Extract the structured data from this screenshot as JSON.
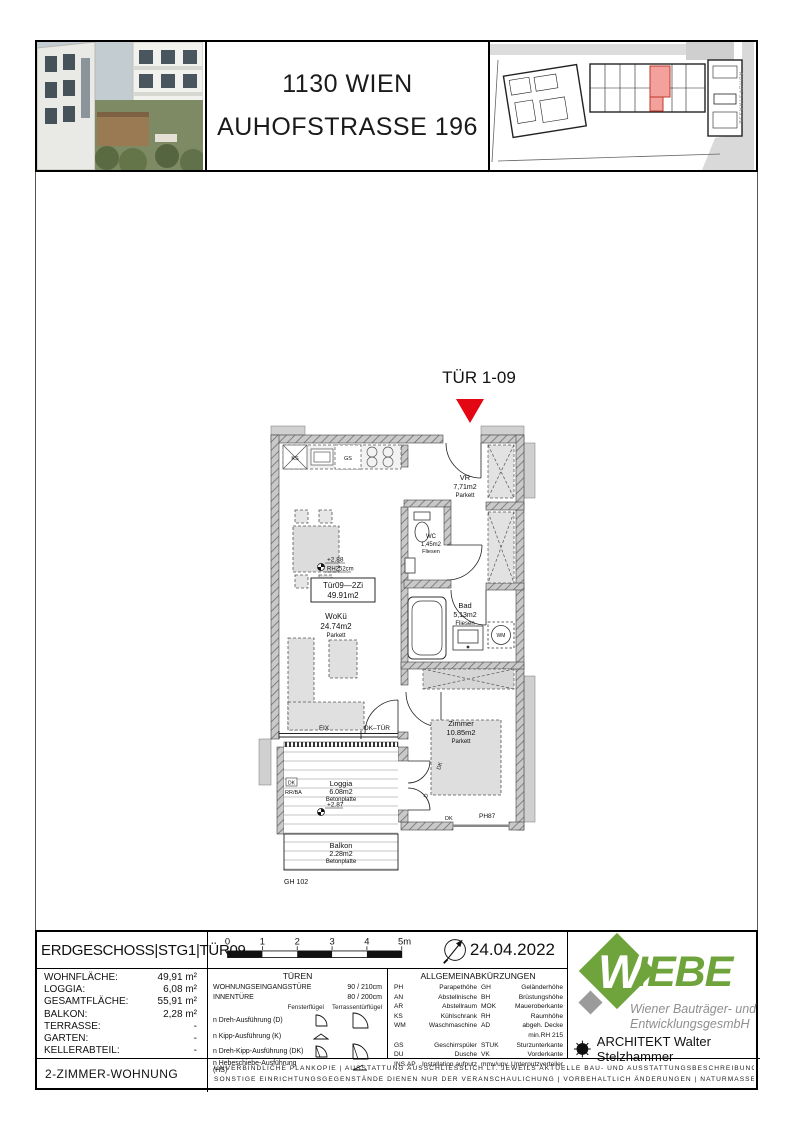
{
  "colors": {
    "accent_red": "#e30613",
    "logo_green": "#6fa43c",
    "siteplan_highlight": "#f2a19c",
    "siteplan_highlight_border": "#c0392b"
  },
  "header": {
    "city_line": "1130 WIEN",
    "street_line": "AUHOFSTRASSE 196",
    "siteplan_street": "AUHOFSTRASSE"
  },
  "plan": {
    "entrance_label": "TÜR 1-09",
    "rooms": {
      "vr": {
        "name": "VR",
        "area": "7,71m2",
        "floor": "Parkett"
      },
      "wc": {
        "name": "WC",
        "area": "1,45m2",
        "floor": "Fliesen"
      },
      "bad": {
        "name": "Bad",
        "area": "5,13m2",
        "floor": "Fliesen"
      },
      "woku": {
        "name": "WoKü",
        "area": "24.74m2",
        "floor": "Parkett"
      },
      "zimmer": {
        "name": "Zimmer",
        "area": "10.85m2",
        "floor": "Parkett"
      },
      "loggia": {
        "name": "Loggia",
        "area": "6.08m2",
        "floor": "Betonplatte"
      },
      "balkon": {
        "name": "Balkon",
        "area": "2.28m2",
        "floor": "Betonplatte"
      }
    },
    "unit_box": {
      "line1": "Tür09—2Zi",
      "line2": "49.91m2"
    },
    "levels": {
      "main": "+2.88",
      "main_rh": "RH252cm",
      "loggia": "+2.87"
    },
    "annotations": {
      "fix": "FIX",
      "dk_tuer": "DK–TÜR",
      "gh": "GH 102",
      "ph": "PH87",
      "ks": "KS",
      "gs": "GS",
      "wm": "WM",
      "rr_ba": "RR/BA",
      "dk": "DK",
      "d": "D"
    }
  },
  "title_block": {
    "plan_title": "ERDGESCHOSS|STG1|TÜR09",
    "areas": [
      {
        "label": "WOHNFLÄCHE:",
        "value": "49,91 m²"
      },
      {
        "label": "LOGGIA:",
        "value": "6,08 m²"
      },
      {
        "label": "GESAMTFLÄCHE:",
        "value": "55,91 m²"
      },
      {
        "label": "BALKON:",
        "value": "2,28 m²"
      },
      {
        "label": "TERRASSE:",
        "value": "-"
      },
      {
        "label": "GARTEN:",
        "value": "-"
      },
      {
        "label": "KELLERABTEIL:",
        "value": "-"
      }
    ],
    "unit_type": "2-ZIMMER-WOHNUNG",
    "scale_ticks": [
      "0",
      "1",
      "2",
      "3",
      "4",
      "5m"
    ],
    "date": "24.04.2022",
    "doors": {
      "title": "TÜREN",
      "entrance_label": "WOHNUNGSEINGANGSTÜRE",
      "entrance_size": "90 / 210cm",
      "inner_label": "INNENTÜRE",
      "inner_size": "80 / 200cm",
      "col_window": "Fensterflügel",
      "col_terrace": "Terrassentürflügel",
      "types": [
        "n Dreh-Ausführung (D)",
        "n Kipp-Ausführung (K)",
        "n Dreh-Kipp-Ausführung (DK)",
        "n Hebeschiebe-Ausführung (HS)"
      ]
    },
    "abbreviations": {
      "title": "ALLGEMEINABKÜRZUNGEN",
      "rows": [
        [
          "PH",
          "Parapethöhe",
          "GH",
          "Geländerhöhe"
        ],
        [
          "AN",
          "Abstellnische",
          "BH",
          "Brüstungshöhe"
        ],
        [
          "AR",
          "Abstellraum",
          "MOK",
          "Maueroberkante"
        ],
        [
          "KS",
          "Kühlschrank",
          "RH",
          "Raumhöhe"
        ],
        [
          "WM",
          "Waschmaschine",
          "AD",
          "abgeh. Decke min.RH 215"
        ],
        [
          "GS",
          "Geschirrspüler",
          "STUK",
          "Sturzunterkante"
        ],
        [
          "DU",
          "Dusche",
          "VK",
          "Vorderkante"
        ],
        [
          "INS.AP",
          "Installation aufputz",
          "mmv/upv",
          "Unterputzverteiler"
        ]
      ]
    },
    "logo": {
      "initial": "W",
      "rest": "IEBE",
      "tagline1": "Wiener Bauträger- und",
      "tagline2": "EntwicklungsgesmbH",
      "architect": "ARCHITEKT  Walter Stelzhammer"
    },
    "disclaimer": [
      "UNVERBINDLICHE PLANKOPIE | AUSSTATTUNG AUSSCHLIESSLICH LT. JEWEILS AKTUELLE BAU- UND AUSSTATTUNGSBESCHREIBUNG",
      "SONSTIGE EINRICHTUNGSGEGENSTÄNDE DIENEN NUR DER VERANSCHAULICHUNG | VORBEHALTLICH ÄNDERUNGEN | NATURMASSE ERFORDERLICH"
    ]
  }
}
